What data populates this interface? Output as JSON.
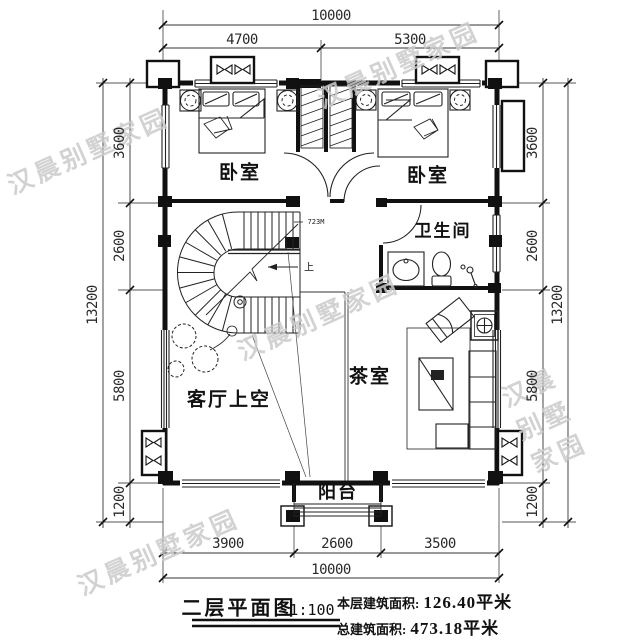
{
  "watermark": {
    "text": "汉晨别墅家园"
  },
  "plan": {
    "rooms": {
      "bedroom_left": "卧室",
      "bedroom_right": "卧室",
      "bathroom": "卫生间",
      "living_void": "客厅上空",
      "tea_room": "茶室",
      "balcony": "阳台"
    },
    "stair": {
      "note": "723M",
      "up": "上"
    }
  },
  "dimensions": {
    "top": {
      "overall": "10000",
      "segments": [
        "4700",
        "5300"
      ]
    },
    "bottom": {
      "overall": "10000",
      "segments": [
        "3900",
        "2600",
        "3500"
      ]
    },
    "left": {
      "overall": "13200",
      "segments": [
        "3600",
        "2600",
        "5800",
        "1200"
      ]
    },
    "right": {
      "overall": "13200",
      "segments": [
        "3600",
        "2600",
        "5800",
        "1200"
      ]
    }
  },
  "title_block": {
    "drawing_title": "二层平面图",
    "scale": "1:100",
    "floor_area_label": "本层建筑面积:",
    "floor_area_value": "126.40平米",
    "total_area_label": "总建筑面积:",
    "total_area_value": "473.18平米"
  }
}
